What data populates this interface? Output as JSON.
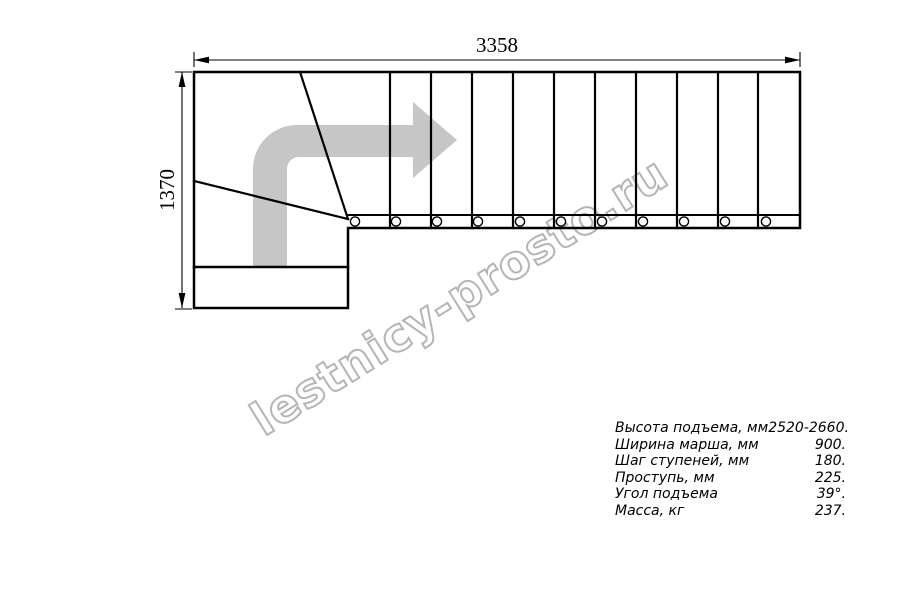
{
  "drawing": {
    "title": "staircase-plan-top-view",
    "width_dimension": "3358",
    "height_dimension": "1370",
    "straight_treads": 11,
    "winder_treads": 3,
    "balusters": 11,
    "direction_arrow": "turn-right-then-forward-arrow"
  },
  "watermark": {
    "text": "lestnicy-prosto.ru"
  },
  "specs": {
    "rows": [
      {
        "label": "Высота подъема, мм",
        "value": "2520-2660."
      },
      {
        "label": "Ширина марша, мм",
        "value": "900."
      },
      {
        "label": "Шаг ступеней, мм",
        "value": "180."
      },
      {
        "label": "Проступь, мм",
        "value": "225."
      },
      {
        "label": "Угол подъема",
        "value": "39°."
      },
      {
        "label": "Масса, кг",
        "value": "237."
      }
    ]
  },
  "colors": {
    "line": "#000000",
    "arrow_fill": "#c6c6c6",
    "watermark_stroke": "#b5b5b5",
    "background": "#ffffff"
  }
}
